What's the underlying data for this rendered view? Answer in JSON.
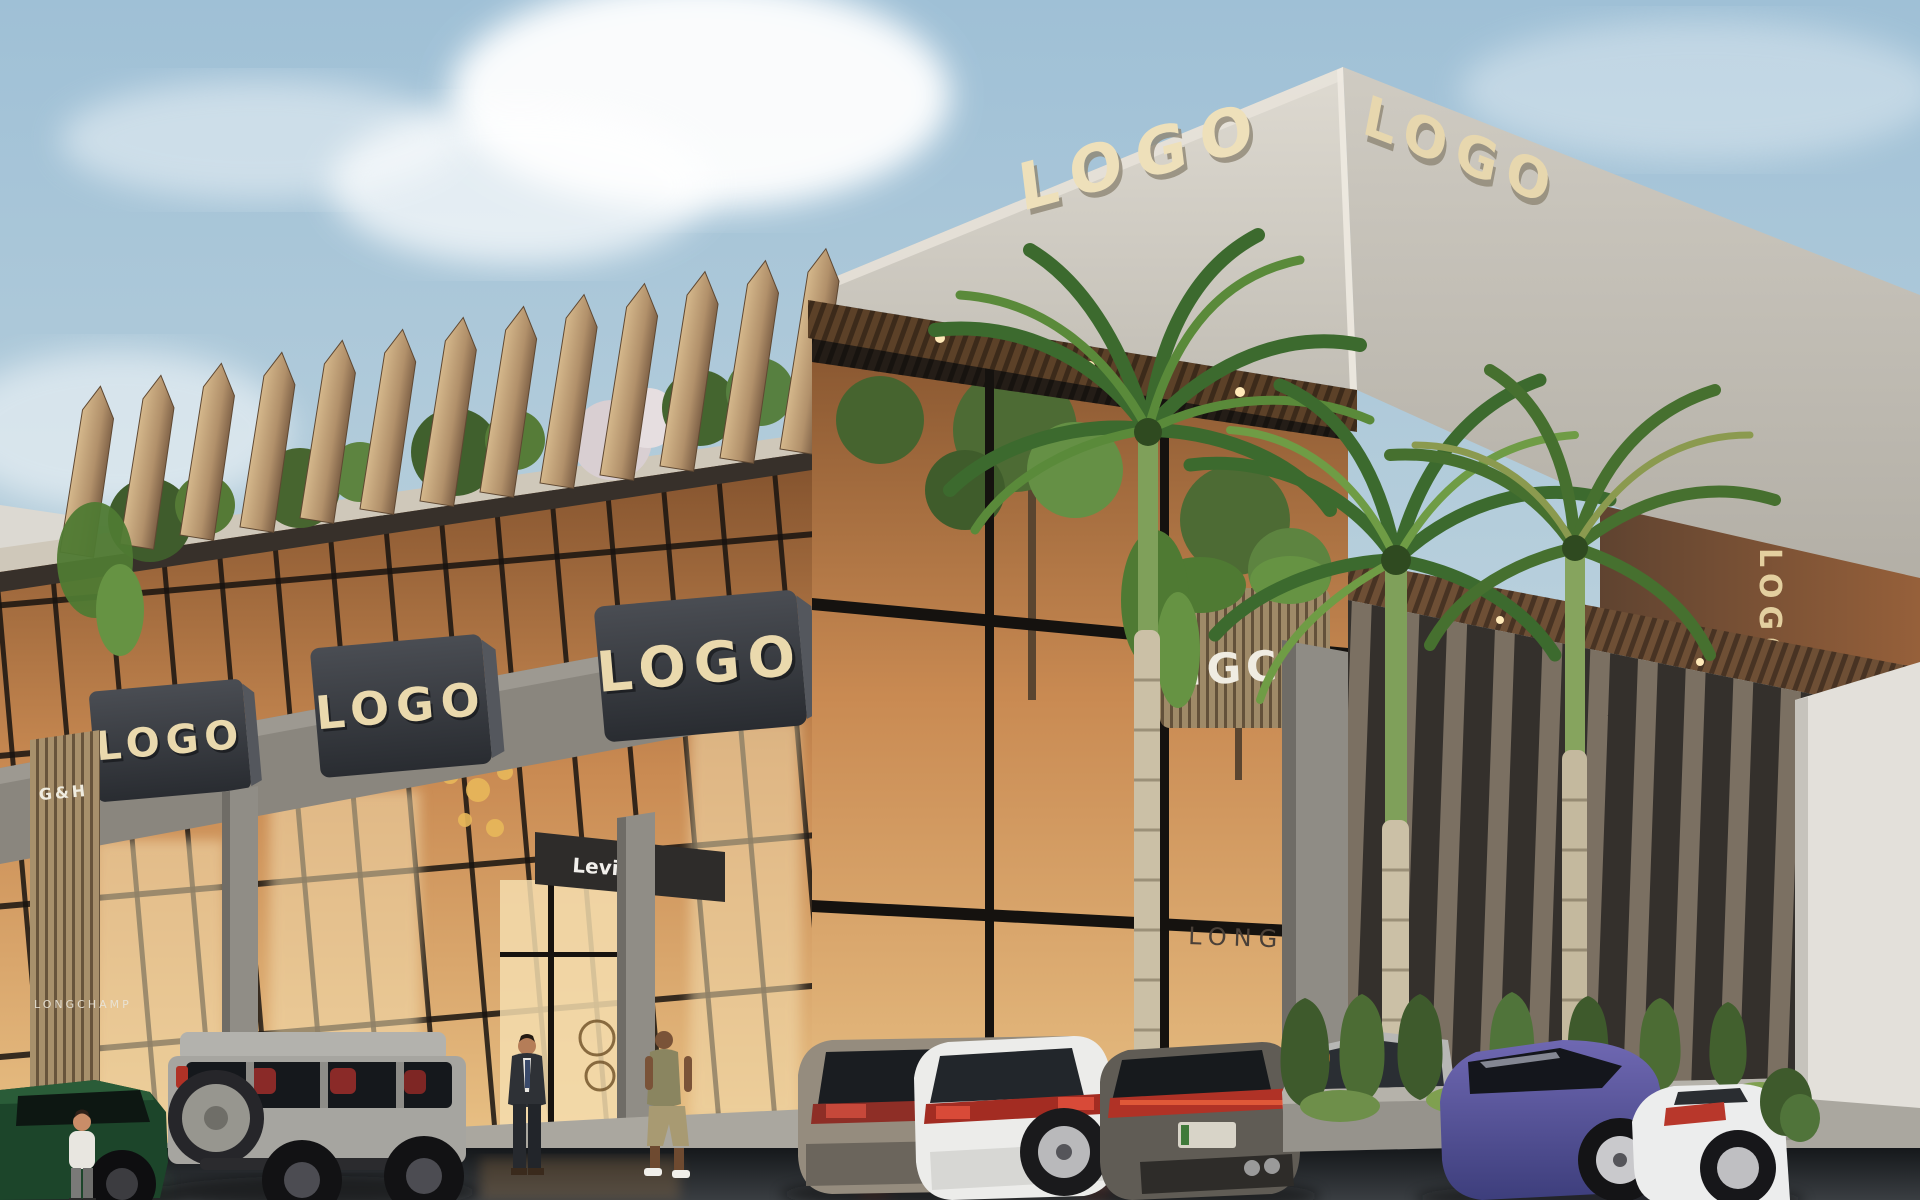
{
  "scene": {
    "description": "Architectural render of a modern luxury shopping mall exterior with palm trees, parked cars and pedestrians",
    "building_signs": {
      "roof_left": "LOGO",
      "roof_right": "LOGO",
      "side_vertical": "LOGO",
      "storefront": [
        "LOGO",
        "LOGO",
        "LOGO",
        "LOGO"
      ]
    },
    "tenant_signs": {
      "left_slat_panel": "G&H",
      "entrance_awning": "Levi's",
      "glass_etched": "LONGCHAMP",
      "interior_slat_panel": "NGCH",
      "left_glass_small": "LONGCHAMP"
    },
    "palette": {
      "sky_top": "#9fc0d6",
      "sky_bottom": "#cddbe2",
      "concrete_light": "#d8d4cb",
      "concrete_shade": "#bdb9b0",
      "sign_box": "#33363c",
      "sign_letters": "#e9d9af",
      "wood_fin": "#b99a73",
      "wood_soffit": "#6e4f35",
      "corten_stripe": "#8a5a33",
      "glass_warm": "#c98a52",
      "interior_glow": "#f3ddb0",
      "stone_pier": "#8f8c85",
      "louver_dark": "#3b3733",
      "louver_light": "#9a8c7b",
      "palm_green": "#4a7a33",
      "planter_green": "#3e5a2c",
      "sidewalk": "#aaa79f",
      "road_wet": "#1c2023",
      "taillight_red": "#b03226",
      "car_green": "#1c452a",
      "car_gray": "#a6a5a0",
      "car_white": "#ececea",
      "car_urus": "#605c55",
      "car_blue": "#4c4d90"
    }
  }
}
